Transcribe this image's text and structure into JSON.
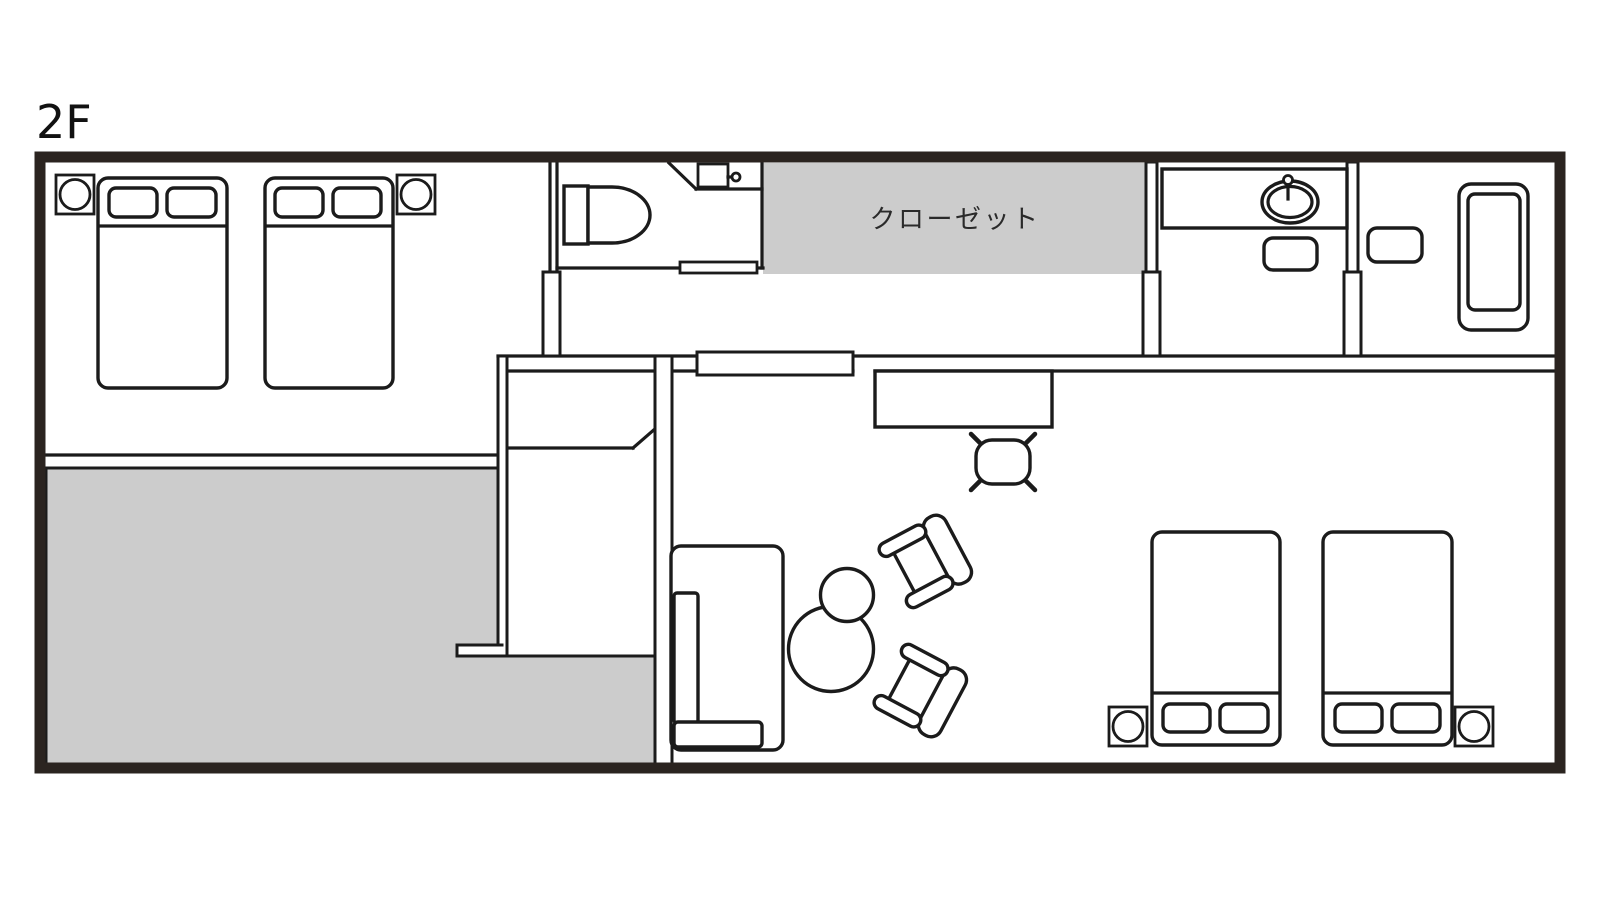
{
  "plan": {
    "floor_label": "2F",
    "closet_label": "クローゼット",
    "colors": {
      "outer_wall": "#2b2420",
      "line": "#1b1b1b",
      "area_fill": "#cccccc",
      "background": "#ffffff",
      "label_text": "#2a2a2a"
    },
    "areas": {
      "closet": "クローゼット",
      "gray_room_bottom_left": "",
      "bedroom_top_left": "",
      "bedroom_bottom_right": "",
      "living_room": "",
      "toilet_room": "",
      "washroom": "",
      "bathroom": "",
      "corridor": ""
    },
    "icons": {
      "bed": "rounded rectangle with two pillow rectangles and headboard line",
      "nightstand": "square with circle",
      "toilet": "tank rectangle with D-shaped bowl",
      "hand-sink": "small rectangle with faucet knob",
      "washbasin": "counter rectangle with double oval sink and faucet",
      "bathtub": "nested rounded rectangles",
      "sofa": "rounded rectangle with back and arm cushions",
      "armchair": "seat with backrest capsule and two armrest capsules",
      "round-table": "circle",
      "floor-cushion": "rounded square with four corner legs",
      "desk": "rectangle",
      "sliding-door": "long thin rectangle on wall",
      "door-jamb": "small vertical rectangle"
    }
  }
}
